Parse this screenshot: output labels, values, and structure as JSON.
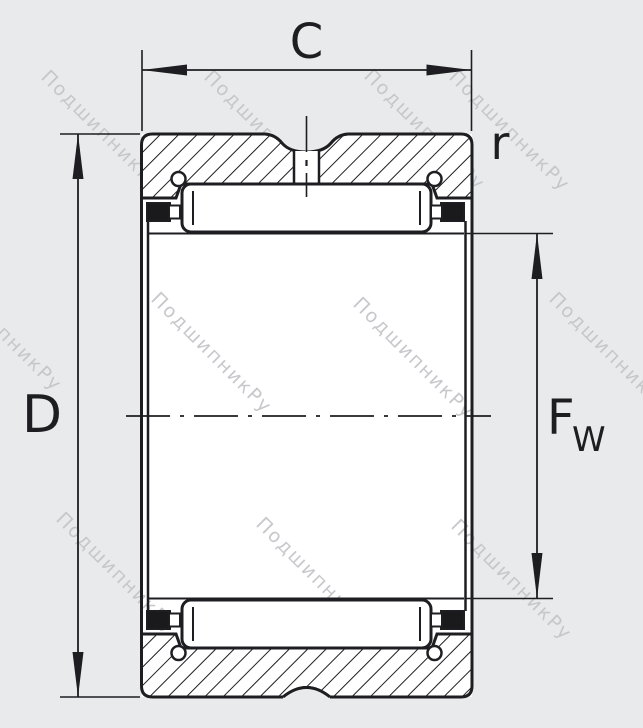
{
  "diagram": {
    "title": "needle-roller-bearing-cross-section",
    "labels": {
      "width": "C",
      "outer_diameter": "D",
      "corner_radius": "r",
      "bore_main": "F",
      "bore_sub": "W"
    },
    "watermark": {
      "text": "ПодшипникРу"
    },
    "colors": {
      "background": "#e9eaeb",
      "paper": "#ffffff",
      "line": "#1e1e22",
      "watermark": "#c5c6c9"
    }
  }
}
